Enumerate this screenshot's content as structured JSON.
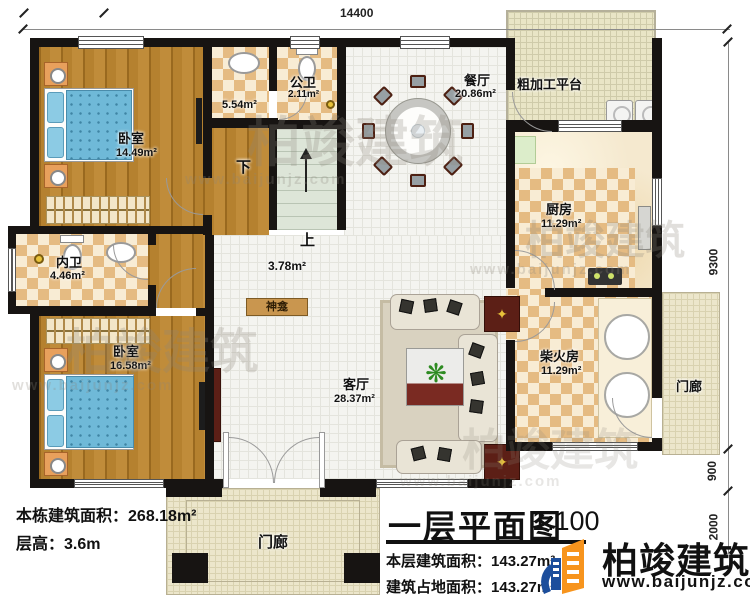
{
  "dimensions": {
    "top_width": "14400",
    "right_main": "9300",
    "right_porch": "900",
    "right_front": "2000"
  },
  "rooms": {
    "bedroom1": {
      "name": "卧室",
      "area": "14.49m²"
    },
    "closet": {
      "area": "5.54m²"
    },
    "public_bath": {
      "name": "公卫",
      "area": "2.11m²"
    },
    "stair_down": {
      "label": "下"
    },
    "stair_up": {
      "label": "上"
    },
    "hall": {
      "area": "3.78m²"
    },
    "dining": {
      "name": "餐厅",
      "area": "20.86m²"
    },
    "platform": {
      "name": "粗加工平台"
    },
    "kitchen": {
      "name": "厨房",
      "area": "11.29m²"
    },
    "ensuite": {
      "name": "内卫",
      "area": "4.46m²"
    },
    "bedroom2": {
      "name": "卧室",
      "area": "16.58m²"
    },
    "living": {
      "name": "客厅",
      "area": "28.37m²"
    },
    "shrine": {
      "name": "神龛"
    },
    "firewood": {
      "name": "柴火房",
      "area": "11.29m²"
    },
    "porch_right": {
      "name": "门廊"
    },
    "porch_front": {
      "name": "门廊"
    }
  },
  "building_info": {
    "total_area_label": "本栋建筑面积：",
    "total_area_value": "268.18m²",
    "floor_height_label": "层高：",
    "floor_height_value": "3.6m"
  },
  "title_block": {
    "title": "一层平面图",
    "scale": "1:100",
    "floor_area_label": "本层建筑面积：",
    "floor_area_value": "143.27m²",
    "footprint_label": "建筑占地面积：",
    "footprint_value": "143.27m²"
  },
  "brand": {
    "name": "柏竣建筑",
    "website": "www.baijunjz.com"
  },
  "watermark": {
    "name": "柏竣建筑",
    "website": "www.baijunjz.com"
  },
  "colors": {
    "wall": "#171412",
    "wood": "#b5812f",
    "checker": "#e5bb82",
    "tile": "#f4f4f0",
    "porch": "#ece6cb",
    "stairs": "#dde5d8",
    "bed_blue": "#6fb9d8",
    "accent_red": "#5c1f16",
    "brand_blue": "#1c4e9c",
    "brand_orange": "#f7941d"
  }
}
